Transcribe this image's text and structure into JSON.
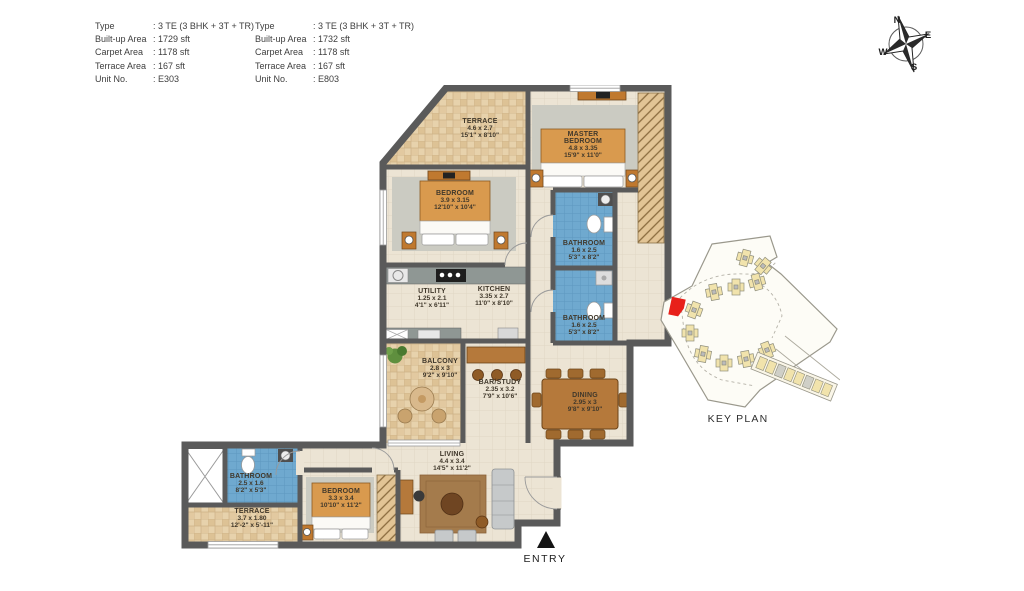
{
  "spec_blocks": [
    {
      "rows": [
        {
          "label": "Type",
          "value": ": 3 TE (3 BHK + 3T + TR)"
        },
        {
          "label": "Built-up Area",
          "value": ": 1729 sft"
        },
        {
          "label": "Carpet Area",
          "value": ": 1178 sft"
        },
        {
          "label": "Terrace Area",
          "value": ": 167 sft"
        },
        {
          "label": "Unit No.",
          "value": ": E303"
        }
      ]
    },
    {
      "rows": [
        {
          "label": "Type",
          "value": ": 3 TE (3 BHK + 3T + TR)"
        },
        {
          "label": "Built-up Area",
          "value": ": 1732 sft"
        },
        {
          "label": "Carpet Area",
          "value": ": 1178 sft"
        },
        {
          "label": "Terrace Area",
          "value": ": 167 sft"
        },
        {
          "label": "Unit No.",
          "value": ": E803"
        }
      ]
    }
  ],
  "compass": {
    "north": "N",
    "east": "E",
    "south": "S",
    "west": "W"
  },
  "rooms": [
    {
      "name": "TERRACE",
      "dim_m": "4.6 x 2.7",
      "dim_ft": "15'1\" x 8'10\""
    },
    {
      "name": "MASTER BEDROOM",
      "dim_m": "4.8 x 3.35",
      "dim_ft": "15'9\" x 11'0\""
    },
    {
      "name": "BEDROOM",
      "dim_m": "3.9 x 3.15",
      "dim_ft": "12'10\" x 10'4\""
    },
    {
      "name": "BATHROOM",
      "dim_m": "1.6 x 2.5",
      "dim_ft": "5'3\" x 8'2\""
    },
    {
      "name": "BATHROOM",
      "dim_m": "1.6 x 2.5",
      "dim_ft": "5'3\" x 8'2\""
    },
    {
      "name": "UTILITY",
      "dim_m": "1.25 x 2.1",
      "dim_ft": "4'1\" x 6'11\""
    },
    {
      "name": "KITCHEN",
      "dim_m": "3.35 x 2.7",
      "dim_ft": "11'0\" x 8'10\""
    },
    {
      "name": "BALCONY",
      "dim_m": "2.8 x 3",
      "dim_ft": "9'2\" x 9'10\""
    },
    {
      "name": "BAR/STUDY",
      "dim_m": "2.35 x 3.2",
      "dim_ft": "7'9\" x 10'6\""
    },
    {
      "name": "DINING",
      "dim_m": "2.95 x 3",
      "dim_ft": "9'8\" x 9'10\""
    },
    {
      "name": "LIVING",
      "dim_m": "4.4 x 3.4",
      "dim_ft": "14'5\" x 11'2\""
    },
    {
      "name": "BEDROOM",
      "dim_m": "3.3 x 3.4",
      "dim_ft": "10'10\" x 11'2\""
    },
    {
      "name": "BATHROOM",
      "dim_m": "2.5 x 1.6",
      "dim_ft": "8'2\" x 5'3\""
    },
    {
      "name": "TERRACE",
      "dim_m": "3.7 x 1.80",
      "dim_ft": "12'-2\" x 5'-11\""
    }
  ],
  "key_plan": {
    "title": "KEY PLAN"
  },
  "entry": {
    "label": "ENTRY"
  },
  "colors": {
    "wall": "#5A5A5A",
    "floor": "#ECE4D4",
    "terrace_tile": "#E7D2AC",
    "bathroom_tile": "#6FA9CF",
    "furniture_brown": "#B5793B",
    "highlight_red": "#E8201A"
  }
}
